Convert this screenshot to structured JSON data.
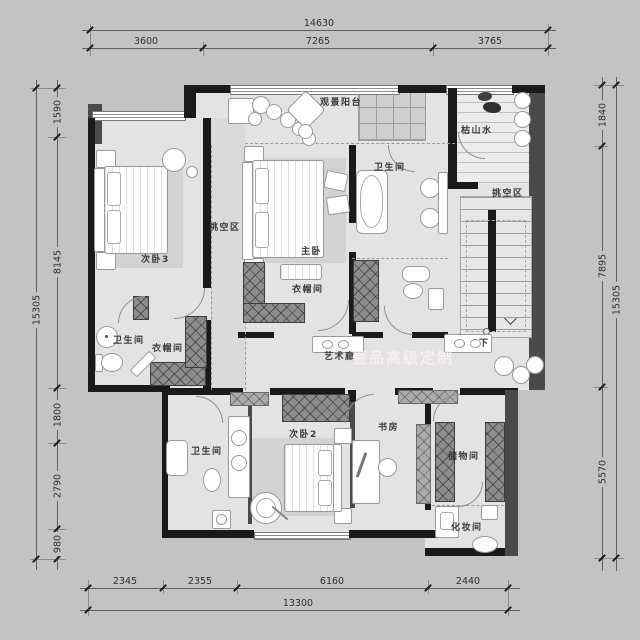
{
  "watermark": "壹品高级定制",
  "rooms": {
    "balcony": "观景阳台",
    "rock_garden": "枯山水",
    "bath_master": "卫生间",
    "void_right": "挑空区",
    "void_left": "挑空区",
    "bedroom3": "次卧3",
    "master": "主卧",
    "closet_master": "衣帽间",
    "bath_left": "卫生间",
    "closet_left": "衣帽间",
    "gallery": "艺术廊",
    "stairs_down": "下",
    "bedroom2": "次卧2",
    "study": "书房",
    "bath_bottom": "卫生间",
    "storage": "储物间",
    "makeup": "化妆间"
  },
  "dims": {
    "top": {
      "total": "14630",
      "segments": [
        "3600",
        "7265",
        "3765"
      ]
    },
    "bottom": {
      "total": "13300",
      "segments": [
        "2345",
        "2355",
        "6160",
        "2440"
      ]
    },
    "left": {
      "total": "15305",
      "segments": [
        "1590",
        "8145",
        "1800",
        "2790",
        "980"
      ]
    },
    "right": {
      "total": "15305",
      "segments": [
        "1840",
        "7895",
        "5570"
      ]
    }
  },
  "colors": {
    "background": "#c3c3c3",
    "floor": "#e3e3e3",
    "wall": "#1a1a1a",
    "wall_secondary": "#4a4a4a",
    "dimension_text": "#2e2e2e",
    "label_text": "#3a3a3a",
    "watermark": "rgba(248,240,240,0.93)"
  }
}
